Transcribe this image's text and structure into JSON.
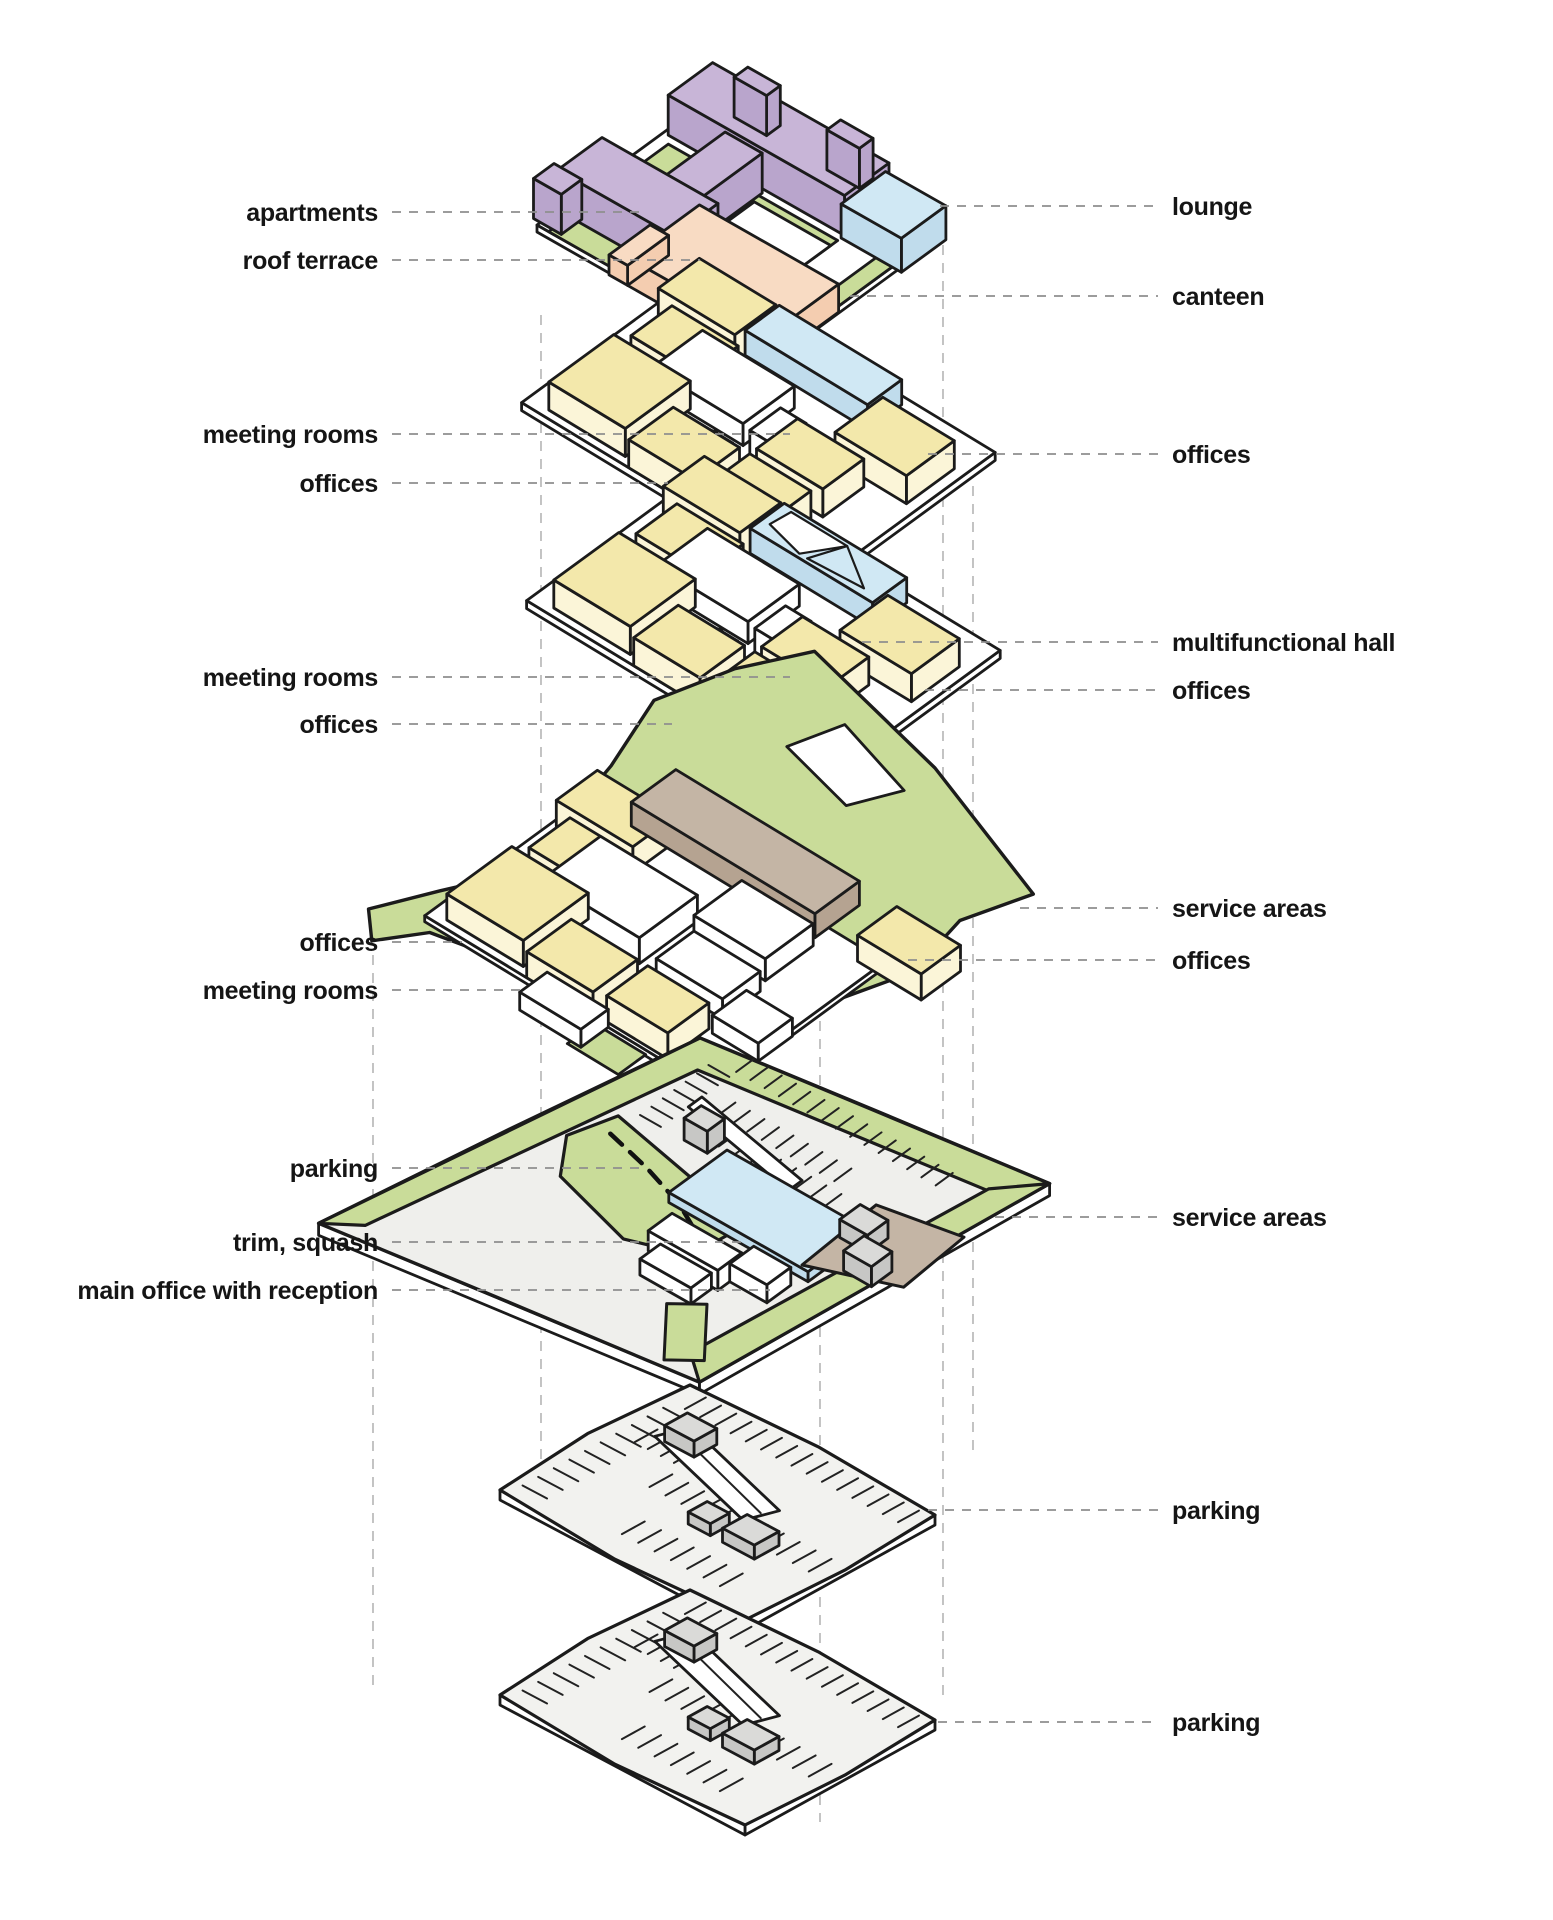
{
  "figure": {
    "type": "exploded-axonometric-building-diagram",
    "background": "#ffffff"
  },
  "palette": {
    "outline": "#1b1b1b",
    "purple_top": "#c8b5d7",
    "purple_side": "#b9a5cc",
    "green_top": "#c9dc99",
    "green_side": "#b7cc80",
    "yellow_top": "#f3e8ab",
    "yellow_side": "#fbf5d8",
    "blue_top": "#d0e8f4",
    "blue_side": "#c0dcec",
    "peach_top": "#f8dbc3",
    "peach_side": "#f4cdb0",
    "brown_top": "#c4b5a5",
    "brown_side": "#b5a391",
    "gray_plate": "#efefec",
    "gray_box_top": "#dadad8",
    "gray_box_side": "#c7c7c5",
    "white": "#ffffff",
    "leader": "#8f8f8f",
    "guide": "#b9b9b9",
    "label_color": "#151515"
  },
  "levels": [
    {
      "name": "roof level",
      "labels_left": [
        {
          "text": "apartments"
        },
        {
          "text": "roof terrace"
        }
      ],
      "labels_right": [
        {
          "text": "lounge"
        },
        {
          "text": "canteen"
        }
      ]
    },
    {
      "name": "upper office level 2",
      "labels_left": [
        {
          "text": "meeting rooms"
        },
        {
          "text": "offices"
        }
      ],
      "labels_right": [
        {
          "text": "offices"
        }
      ]
    },
    {
      "name": "upper office level 1",
      "labels_left": [
        {
          "text": "meeting rooms"
        },
        {
          "text": "offices"
        }
      ],
      "labels_right": [
        {
          "text": "multifunctional hall"
        },
        {
          "text": "offices"
        }
      ]
    },
    {
      "name": "podium office level",
      "labels_left": [
        {
          "text": "offices"
        },
        {
          "text": "meeting rooms"
        }
      ],
      "labels_right": [
        {
          "text": "service areas"
        },
        {
          "text": "offices"
        }
      ]
    },
    {
      "name": "ground level",
      "labels_left": [
        {
          "text": "parking"
        },
        {
          "text": "trim, squash"
        },
        {
          "text": "main office with reception"
        }
      ],
      "labels_right": [
        {
          "text": "service areas"
        }
      ]
    },
    {
      "name": "parking level -1",
      "labels_left": [],
      "labels_right": [
        {
          "text": "parking"
        }
      ]
    },
    {
      "name": "parking level -2",
      "labels_left": [],
      "labels_right": [
        {
          "text": "parking"
        }
      ]
    }
  ]
}
